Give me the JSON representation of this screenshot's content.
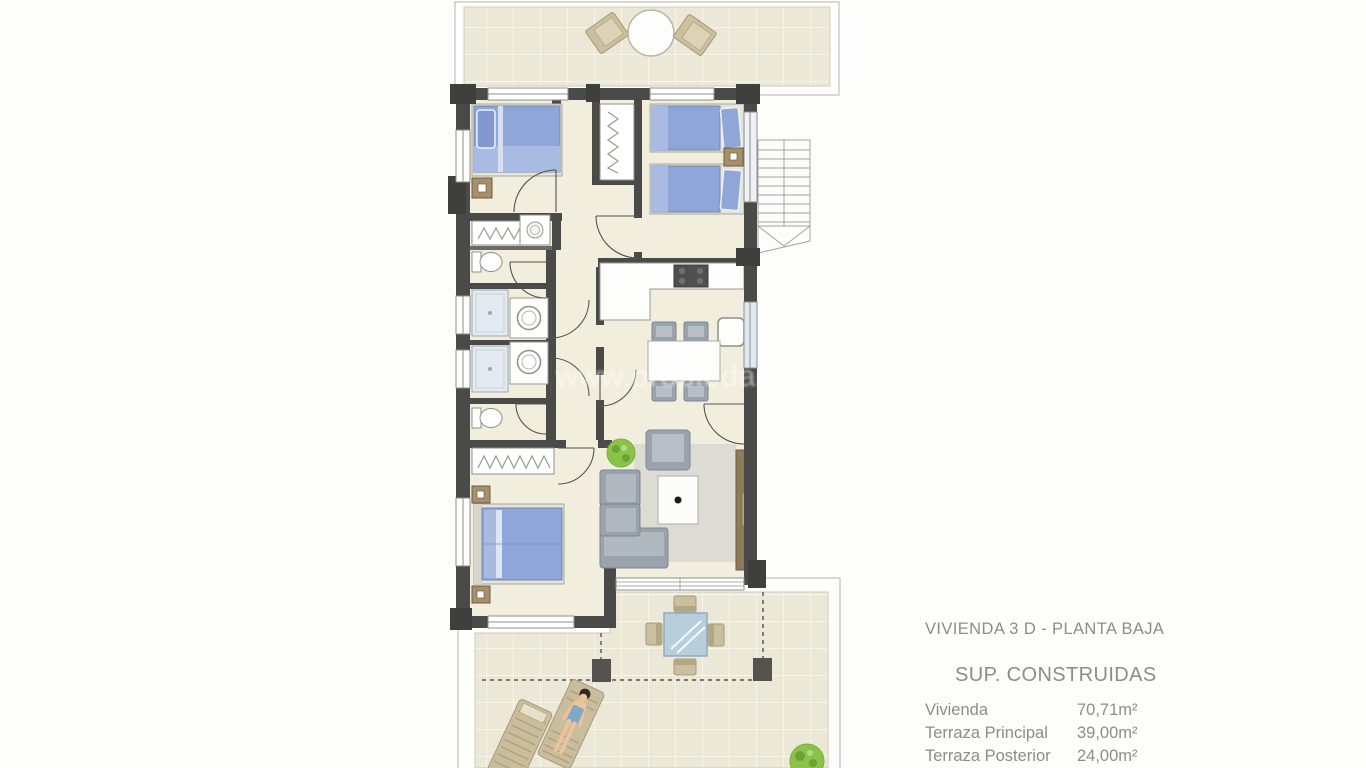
{
  "legend": {
    "title": "VIVIENDA 3 D - PLANTA BAJA",
    "section_title": "SUP. CONSTRUIDAS",
    "rows": [
      {
        "label": "Vivienda",
        "value": "70,71m²"
      },
      {
        "label": "Terraza Principal",
        "value": "39,00m²"
      },
      {
        "label": "Terraza Posterior",
        "value": "24,00m²"
      }
    ],
    "text_color": "#8d8d88"
  },
  "watermark": {
    "text": "www.propiedades.es"
  },
  "plan": {
    "type": "apartment-floor-plan",
    "rooms": [
      "terraza-posterior",
      "dormitorio-2",
      "dormitorio-1-twin",
      "armario-vestidor",
      "lavadero-aseo",
      "bano-1",
      "bano-2",
      "aseo-2",
      "cocina",
      "salon-comedor",
      "dormitorio-principal",
      "terraza-principal",
      "escalera-exterior"
    ],
    "furniture": [
      "terrace-chairs",
      "round-table",
      "single-bed",
      "twin-beds",
      "double-bed",
      "nightstands",
      "wardrobe-hangers",
      "washing-machine",
      "toilets",
      "showers",
      "vanity-sinks",
      "kitchen-counter",
      "stove",
      "fridge",
      "dining-table-chairs",
      "sofa-l-shape",
      "armchair",
      "coffee-table",
      "rug",
      "tv-cabinet",
      "plants",
      "outdoor-dining-set",
      "pergola-posts",
      "sun-loungers",
      "sunbathing-person",
      "stairs"
    ],
    "colors": {
      "wall": "#4a4a48",
      "floor": "#f2eedd",
      "terrace_tile": "#ebe8d8",
      "bed_blue": "#8ea6d8",
      "furniture_gray": "#9aa3ad",
      "wood_brown": "#8d7b5a",
      "nightstand_brown": "#a5906b",
      "terrace_tan": "#cbbf9f",
      "glass_blue": "#b9cedd",
      "plant_green": "#8bc34a",
      "boundary_line": "#b6b4a6"
    }
  }
}
